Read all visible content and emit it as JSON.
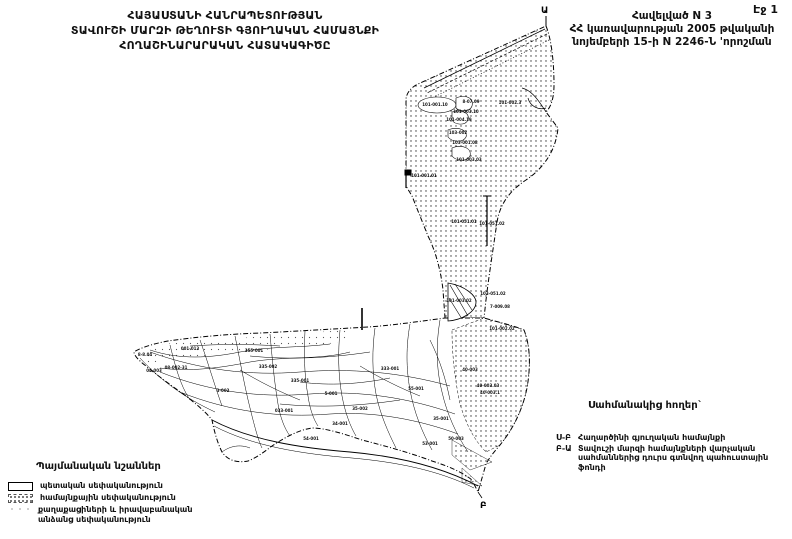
{
  "theme": {
    "ink": "#111111",
    "paper": "#ffffff"
  },
  "page": {
    "page_label": "Էջ 1"
  },
  "title": {
    "line1": "ՀԱՅԱՍՏԱՆԻ ՀԱՆՐԱՊԵՏՈՒԹՅԱՆ",
    "line2": "ՏԱՎՈՒՇԻ ՄԱՐԶԻ ԹԵՂՈՒՏԻ ԳՅՈՒՂԱԿԱՆ ՀԱՄԱՅՆՔԻ",
    "line3": "ՀՈՂԱՇԻՆԱՐԱՐԱԿԱՆ ՀԱՏԱԿԱԳԻԾԸ"
  },
  "appendix": {
    "line1": "Հավելված N  3",
    "line2": "ՀՀ կառավարության 2005 թվականի",
    "line3": "նոյեմբերի 15-ի N 2246-Ն 'որոշման"
  },
  "legend": {
    "heading": "Պայմանական նշաններ",
    "items": [
      {
        "swatch": "outline",
        "label": "պետական սեփականություն"
      },
      {
        "swatch": "dotted",
        "label": "համայնքային սեփականություն"
      },
      {
        "swatch": "sparse-dots",
        "label": "քաղաքացիների և իրավաբանական անձանց սեփականություն"
      }
    ]
  },
  "bordering": {
    "heading": "Սահմանակից հողեր`",
    "entries": [
      {
        "code": "Ս-Բ",
        "label": "Հաղարծինի  գյուղական համայնքի"
      },
      {
        "code": "Բ-Ա",
        "label": "Տավուշի մարզի համայնքների վարչական սահմաններից դուրս գտնվող պահուստային ֆոնդի"
      }
    ]
  },
  "map": {
    "marker_top": "Ա",
    "marker_bottom": "Բ",
    "parcels": [
      {
        "label": "101-001.10",
        "x": 435,
        "y": 106
      },
      {
        "label": "8-07.09",
        "x": 471,
        "y": 103
      },
      {
        "label": "101-002.3",
        "x": 510,
        "y": 104
      },
      {
        "label": "101-003.10",
        "x": 466,
        "y": 113
      },
      {
        "label": "101-004.19",
        "x": 459,
        "y": 121
      },
      {
        "label": "103-002",
        "x": 458,
        "y": 134
      },
      {
        "label": "103-001.08",
        "x": 465,
        "y": 144
      },
      {
        "label": "101-003.03",
        "x": 469,
        "y": 161
      },
      {
        "label": "101-001.01",
        "x": 424,
        "y": 177
      },
      {
        "label": "101-051.01",
        "x": 464,
        "y": 223
      },
      {
        "label": "101-051.02",
        "x": 492,
        "y": 225
      },
      {
        "label": "103-051.02",
        "x": 493,
        "y": 295
      },
      {
        "label": "7-009.08",
        "x": 500,
        "y": 308
      },
      {
        "label": "101-003.02",
        "x": 459,
        "y": 302
      },
      {
        "label": "101-002.02",
        "x": 502,
        "y": 330
      },
      {
        "label": "40-003",
        "x": 470,
        "y": 371
      },
      {
        "label": "40-003.03",
        "x": 488,
        "y": 387
      },
      {
        "label": "40-003.1",
        "x": 490,
        "y": 394
      },
      {
        "label": "001-013",
        "x": 190,
        "y": 350
      },
      {
        "label": "08-002-31",
        "x": 176,
        "y": 369
      },
      {
        "label": "355-001",
        "x": 254,
        "y": 352
      },
      {
        "label": "335-002",
        "x": 268,
        "y": 368
      },
      {
        "label": "335-001",
        "x": 300,
        "y": 382
      },
      {
        "label": "5-001",
        "x": 331,
        "y": 395
      },
      {
        "label": "333-001",
        "x": 390,
        "y": 370
      },
      {
        "label": "55-001",
        "x": 416,
        "y": 390
      },
      {
        "label": "35-002",
        "x": 360,
        "y": 410
      },
      {
        "label": "033-001",
        "x": 284,
        "y": 412
      },
      {
        "label": "3-002",
        "x": 223,
        "y": 392
      },
      {
        "label": "35-001",
        "x": 441,
        "y": 420
      },
      {
        "label": "34-001",
        "x": 340,
        "y": 425
      },
      {
        "label": "50-003",
        "x": 456,
        "y": 440
      },
      {
        "label": "53-001",
        "x": 430,
        "y": 445
      },
      {
        "label": "54-001",
        "x": 311,
        "y": 440
      },
      {
        "label": "8-8.04",
        "x": 145,
        "y": 356
      },
      {
        "label": "04-003",
        "x": 154,
        "y": 372
      }
    ]
  }
}
